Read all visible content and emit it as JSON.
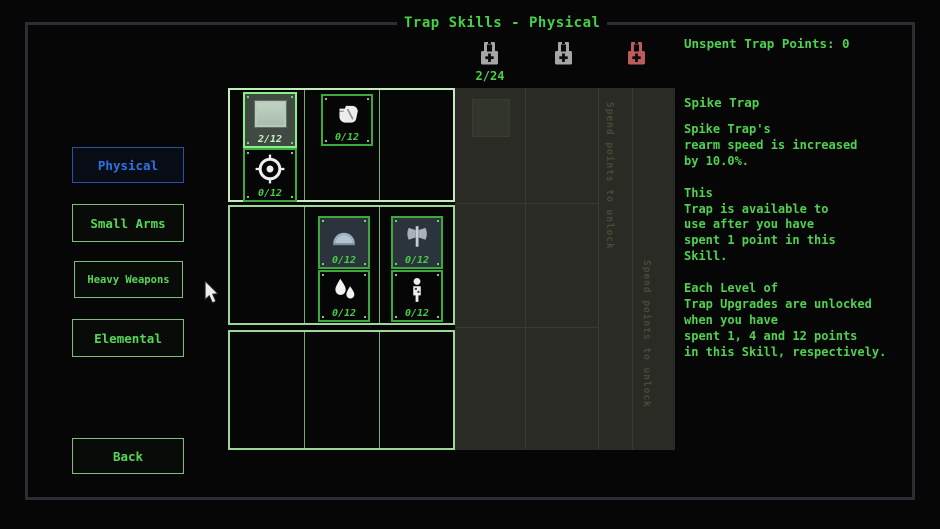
{
  "window": {
    "title": "Trap Skills - Physical"
  },
  "header": {
    "unspent_points": "Unspent Trap Points: 0",
    "tier_progress": "2/24",
    "locks": [
      {
        "name": "locked-tier-lock-1",
        "color": "#a6a6a6"
      },
      {
        "name": "locked-tier-lock-2",
        "color": "#a6a6a6"
      },
      {
        "name": "locked-tier-lock-3",
        "color": "#bd5b5b"
      }
    ]
  },
  "sidebar": {
    "buttons": [
      {
        "label": "Physical",
        "selected": true
      },
      {
        "label": "Small Arms",
        "selected": false
      },
      {
        "label": "Heavy Weapons",
        "selected": false
      },
      {
        "label": "Elemental",
        "selected": false
      }
    ],
    "back_label": "Back"
  },
  "skill_grid": {
    "skills": [
      {
        "id": "spike-plate",
        "points": "2/12",
        "selected": true
      },
      {
        "id": "crosshair",
        "points": "0/12",
        "selected": false
      },
      {
        "id": "fist",
        "points": "0/12",
        "selected": false
      },
      {
        "id": "dome",
        "points": "0/12",
        "selected": false
      },
      {
        "id": "droplets",
        "points": "0/12",
        "selected": false
      },
      {
        "id": "axe",
        "points": "0/12",
        "selected": false
      },
      {
        "id": "figure",
        "points": "0/12",
        "selected": false
      }
    ],
    "locked_column_labels": [
      "Spend points to unlock",
      "Spend points to unlock"
    ]
  },
  "detail_panel": {
    "skill_name": "Spike Trap",
    "description": "Spike Trap's\nrearm speed is increased\nby 10.0%.\n\nThis\nTrap is available to\nuse after you have\nspent 1 point in this\nSkill.\n\nEach Level of\nTrap Upgrades are unlocked\nwhen you have\nspent 1, 4 and 12 points\nin this Skill, respectively."
  },
  "colors": {
    "accent_green": "#4fd24f",
    "accent_blue": "#2f72e4",
    "lock_gray": "#a6a6a6",
    "lock_red": "#bd5b5b",
    "locked_panel_bg": "#292b24"
  }
}
